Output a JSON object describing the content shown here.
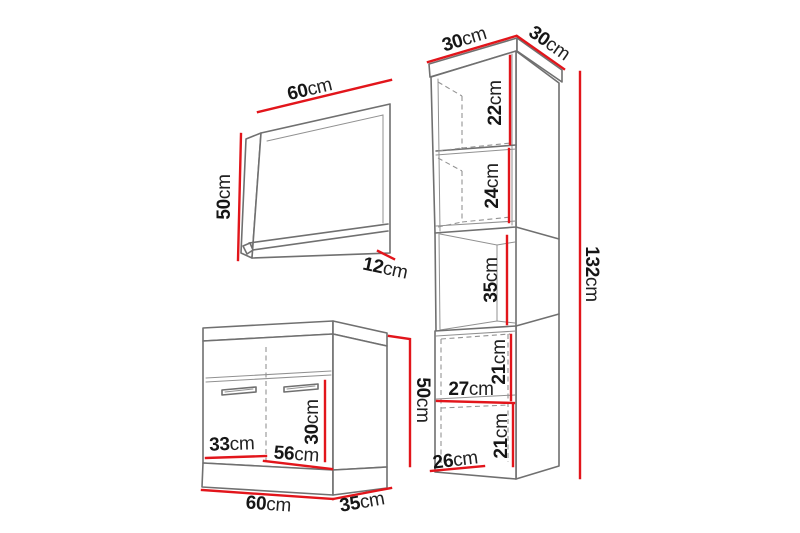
{
  "colors": {
    "dimension_line": "#e2151b",
    "outline": "#707070",
    "hidden_line": "#939393",
    "text": "#161616",
    "background": "#ffffff"
  },
  "mirror": {
    "width": {
      "value": "60",
      "unit": "cm"
    },
    "height": {
      "value": "50",
      "unit": "cm"
    },
    "shelf_depth": {
      "value": "12",
      "unit": "cm"
    }
  },
  "washbasin_cabinet": {
    "width": {
      "value": "60",
      "unit": "cm"
    },
    "depth": {
      "value": "35",
      "unit": "cm"
    },
    "height": {
      "value": "50",
      "unit": "cm"
    },
    "door_height": {
      "value": "30",
      "unit": "cm"
    },
    "inner_width_left": {
      "value": "33",
      "unit": "cm"
    },
    "inner_width": {
      "value": "56",
      "unit": "cm"
    }
  },
  "tall_cabinet": {
    "width": {
      "value": "30",
      "unit": "cm"
    },
    "depth": {
      "value": "30",
      "unit": "cm"
    },
    "height": {
      "value": "132",
      "unit": "cm"
    },
    "top_shelf": {
      "value": "22",
      "unit": "cm"
    },
    "second_shelf": {
      "value": "24",
      "unit": "cm"
    },
    "open_section": {
      "value": "35",
      "unit": "cm"
    },
    "upper_compartment": {
      "value": "21",
      "unit": "cm"
    },
    "compartment_width": {
      "value": "27",
      "unit": "cm"
    },
    "lower_compartment": {
      "value": "21",
      "unit": "cm"
    },
    "bottom_width": {
      "value": "26",
      "unit": "cm"
    }
  }
}
